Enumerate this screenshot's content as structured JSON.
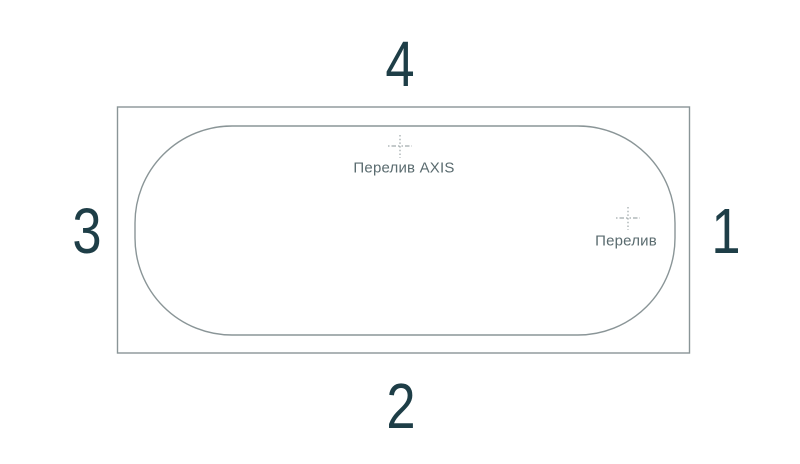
{
  "diagram": {
    "kind": "bathtub-top-view-technical-drawing",
    "sides": [
      {
        "position": "right",
        "number": "1"
      },
      {
        "position": "bottom",
        "number": "2"
      },
      {
        "position": "left",
        "number": "3"
      },
      {
        "position": "top",
        "number": "4"
      }
    ],
    "markers": [
      {
        "name": "overflow-axis",
        "label": "Перелив AXIS"
      },
      {
        "name": "overflow",
        "label": "Перелив"
      }
    ],
    "colors": {
      "background": "#ffffff",
      "line": "#8a9597",
      "marker": "#8a9597",
      "number_text": "#1e3e47",
      "label_text": "#5a6b6f"
    }
  }
}
